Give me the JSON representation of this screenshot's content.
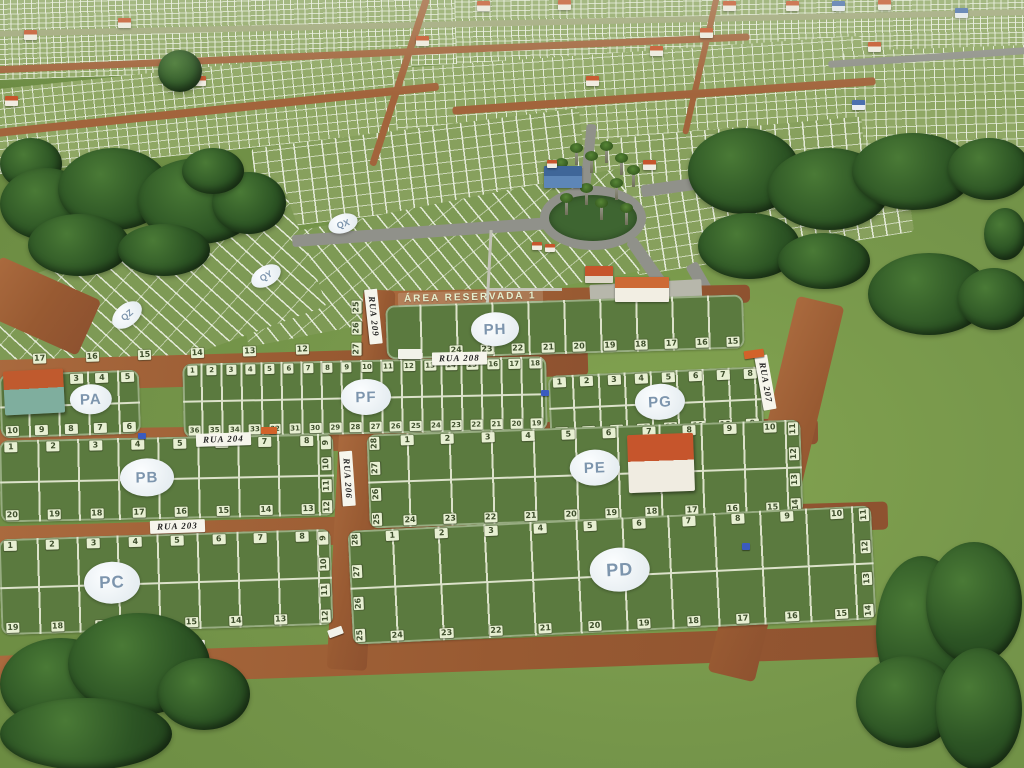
{
  "area_reserved_label": "ÁREA RESERVADA 1",
  "streets": {
    "rua_203": "RUA 203",
    "rua_204": "RUA 204",
    "rua_206": "RUA 206",
    "rua_207": "RUA 207",
    "rua_208": "RUA 208",
    "rua_209": "RUA 209",
    "rua_212": "RUA 212"
  },
  "background_blocks": {
    "QX": "QX",
    "QY": "QY",
    "QZ": "QZ"
  },
  "upper_strip": [
    "17",
    "16",
    "15",
    "14",
    "13",
    "12"
  ],
  "blocks": {
    "PA": {
      "label": "PA",
      "top": [
        "2",
        "3",
        "4",
        "5"
      ],
      "bottom": [
        "10",
        "9",
        "8",
        "7",
        "6"
      ]
    },
    "PB": {
      "label": "PB",
      "top": [
        "1",
        "2",
        "3",
        "4",
        "5",
        "6",
        "7",
        "8"
      ],
      "right": [
        "9",
        "10",
        "11",
        "12"
      ],
      "bottom": [
        "20",
        "19",
        "18",
        "17",
        "16",
        "15",
        "14",
        "13"
      ]
    },
    "PC": {
      "label": "PC",
      "top": [
        "1",
        "2",
        "3",
        "4",
        "5",
        "6",
        "7",
        "8"
      ],
      "right": [
        "9",
        "10",
        "11",
        "12"
      ],
      "bottom": [
        "19",
        "18",
        "17",
        "16",
        "15",
        "14",
        "13"
      ]
    },
    "PD": {
      "label": "PD",
      "left": [
        "28",
        "27",
        "26",
        "25"
      ],
      "top": [
        "1",
        "2",
        "3",
        "4",
        "5",
        "6",
        "7",
        "8",
        "9",
        "10"
      ],
      "right": [
        "11",
        "12",
        "13",
        "14"
      ],
      "bottom": [
        "24",
        "23",
        "22",
        "21",
        "20",
        "19",
        "18",
        "17",
        "16",
        "15"
      ]
    },
    "PE": {
      "label": "PE",
      "left": [
        "28",
        "27",
        "26",
        "25"
      ],
      "top": [
        "1",
        "2",
        "3",
        "4",
        "5",
        "6",
        "7",
        "8",
        "9",
        "10"
      ],
      "right": [
        "11",
        "12",
        "13",
        "14"
      ],
      "bottom": [
        "24",
        "23",
        "22",
        "21",
        "20",
        "19",
        "18",
        "17",
        "16",
        "15"
      ]
    },
    "PF": {
      "label": "PF",
      "top": [
        "1",
        "2",
        "3",
        "4",
        "5",
        "6",
        "7",
        "8",
        "9",
        "10",
        "11",
        "12",
        "13",
        "14",
        "15",
        "16",
        "17",
        "18"
      ],
      "bottom": [
        "36",
        "35",
        "34",
        "33",
        "32",
        "31",
        "30",
        "29",
        "28",
        "27",
        "26",
        "25",
        "24",
        "23",
        "22",
        "21",
        "20",
        "19"
      ]
    },
    "PG": {
      "label": "PG",
      "top": [
        "1",
        "2",
        "3",
        "4",
        "5",
        "6",
        "7",
        "8"
      ],
      "bottom": [
        "16",
        "15",
        "14",
        "13",
        "12",
        "11",
        "10",
        "9"
      ]
    },
    "PH": {
      "label": "PH",
      "left": [
        "25",
        "26",
        "27"
      ],
      "bottom": [
        "24",
        "23",
        "22",
        "21",
        "20",
        "19",
        "18",
        "17",
        "16",
        "15"
      ]
    }
  },
  "icons": {
    "house": "house-icon",
    "tree": "tree-icon",
    "palm": "palm-tree-icon",
    "car": "car-icon",
    "truck": "truck-icon",
    "bus": "bus-icon"
  },
  "palette": {
    "grass": "#75954a",
    "block_grass": "#5b7a3f",
    "plot_line": "#dce2ca",
    "dirt_road": "#9c5f36",
    "paved_road": "#90918a",
    "lot_tag_bg": "#e7efd2",
    "lot_tag_text": "#3e4e2c",
    "block_label_text": "#7d95ad",
    "street_sign_bg": "#f6f5ec",
    "roof_orange": "#c6552c",
    "roof_blue": "#4a6fae",
    "tree_green": "#2c5424"
  }
}
